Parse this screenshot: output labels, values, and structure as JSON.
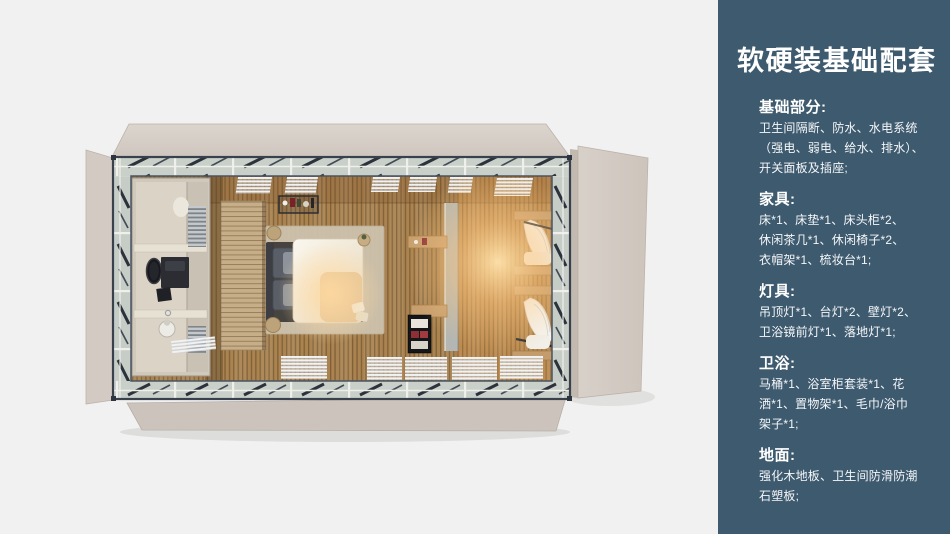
{
  "panel": {
    "title": "软硬装基础配套",
    "sections": [
      {
        "heading": "基础部分:",
        "lines": [
          "卫生间隔断、防水、水电系统",
          "（强电、弱电、给水、排水）、",
          "开关面板及插座;"
        ]
      },
      {
        "heading": "家具:",
        "lines": [
          "床*1、床垫*1、床头柜*2、",
          "休闲茶几*1、休闲椅子*2、",
          "衣帽架*1、梳妆台*1;"
        ]
      },
      {
        "heading": "灯具:",
        "lines": [
          "吊顶灯*1、台灯*2、壁灯*2、",
          "卫浴镜前灯*1、落地灯*1;"
        ]
      },
      {
        "heading": "卫浴:",
        "lines": [
          "马桶*1、浴室柜套装*1、花",
          "洒*1、置物架*1、毛巾/浴巾",
          "架子*1;"
        ]
      },
      {
        "heading": "地面:",
        "lines": [
          "强化木地板、卫生间防滑防潮",
          "石塑板;"
        ]
      }
    ]
  },
  "colors": {
    "panel_background": "#3e5a6e",
    "panel_text": "#ffffff",
    "render_background": "#f1f1f1",
    "wall_panel_beige": "#d5cdc5",
    "floor_wood": "#aa8350",
    "frame_dark": "#39414d",
    "warm_light": "#ffd9a0"
  }
}
